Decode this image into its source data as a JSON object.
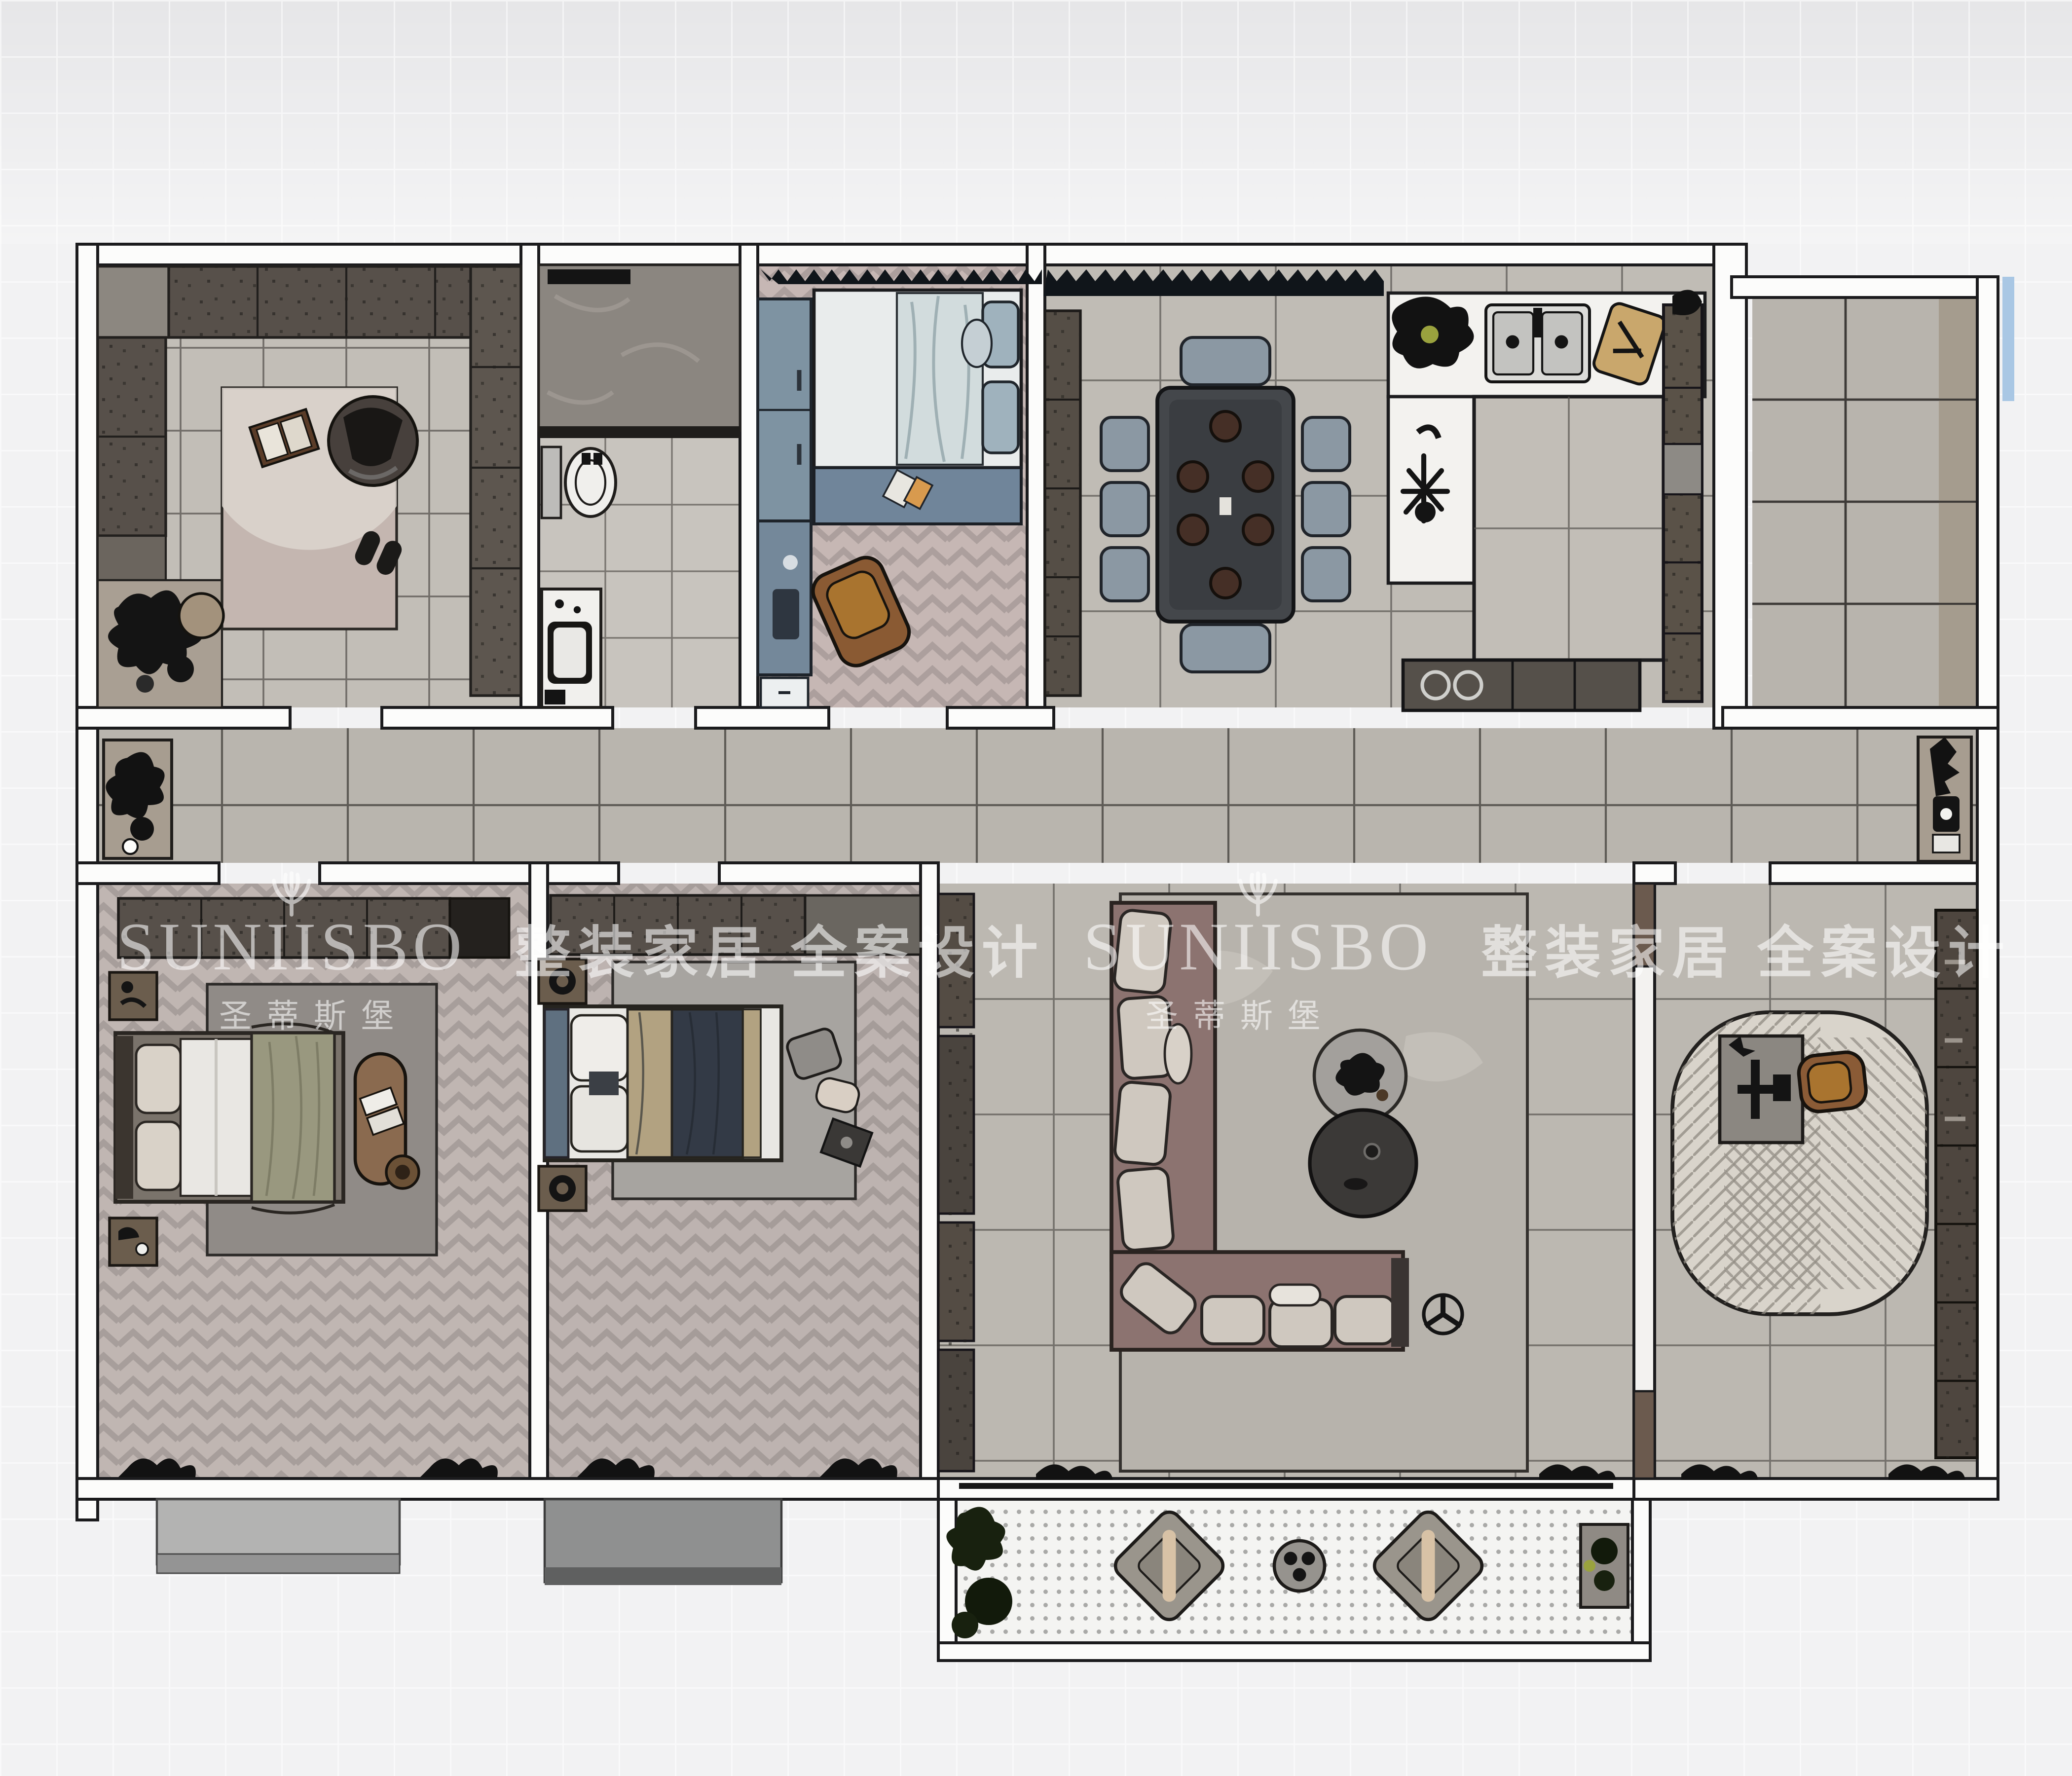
{
  "watermark": {
    "brand": "SUNIISBO",
    "brand_cn": "圣蒂斯堡",
    "slogan": "整装家居 全案设计"
  },
  "palette": {
    "background": "#f2f2f3",
    "wall_fill": "#fcfcfb",
    "wall_line": "#1b1b1d",
    "floor_tile_gray": "#bfbbb4",
    "floor_herringbone_pink": "#c6b7b4",
    "floor_herringbone_gray": "#c0b6b2",
    "cabinet_dark_brown": "#57504a",
    "kids_blue": "#7e93a2",
    "sofa_mauve": "#8c7370",
    "cushion_light": "#cfc8bf",
    "wood_brown": "#8a5b36",
    "rug_study": "#d9d4cb",
    "rug_master": "#908b87",
    "balcony_floor": "#f4f4f2",
    "accent_blue_strip": "#a9c7e4",
    "watermark_white": "rgba(255,255,255,0.58)"
  },
  "rooms": [
    {
      "name": "cloakroom-lounge",
      "furniture": [
        "wardrobes",
        "lounge-chair",
        "rug",
        "books",
        "ottoman",
        "plants"
      ]
    },
    {
      "name": "bathroom",
      "furniture": [
        "shower",
        "toilet",
        "vanity-sink"
      ]
    },
    {
      "name": "kids-bedroom",
      "furniture": [
        "wardrobe",
        "bed",
        "desk",
        "chair"
      ]
    },
    {
      "name": "dining-kitchen",
      "furniture": [
        "dining-table",
        "six-chairs",
        "double-sink",
        "cooktop",
        "cutting-board",
        "counters",
        "tall-cabinets"
      ]
    },
    {
      "name": "utility-room",
      "furniture": []
    },
    {
      "name": "hallway",
      "furniture": [
        "plant-stand",
        "entry-console"
      ]
    },
    {
      "name": "master-bedroom",
      "furniture": [
        "wardrobe",
        "bed",
        "bench",
        "nightstands",
        "rug"
      ]
    },
    {
      "name": "second-bedroom",
      "furniture": [
        "wardrobe",
        "bed",
        "nightstands",
        "rug"
      ]
    },
    {
      "name": "living-room",
      "furniture": [
        "corner-sofa",
        "coffee-tables",
        "side-table",
        "tv-cabinet",
        "rug"
      ]
    },
    {
      "name": "study",
      "furniture": [
        "desk",
        "chair",
        "oval-rug",
        "bookshelf"
      ]
    },
    {
      "name": "balcony",
      "furniture": [
        "lounge-chairs",
        "round-table",
        "plants"
      ]
    }
  ]
}
